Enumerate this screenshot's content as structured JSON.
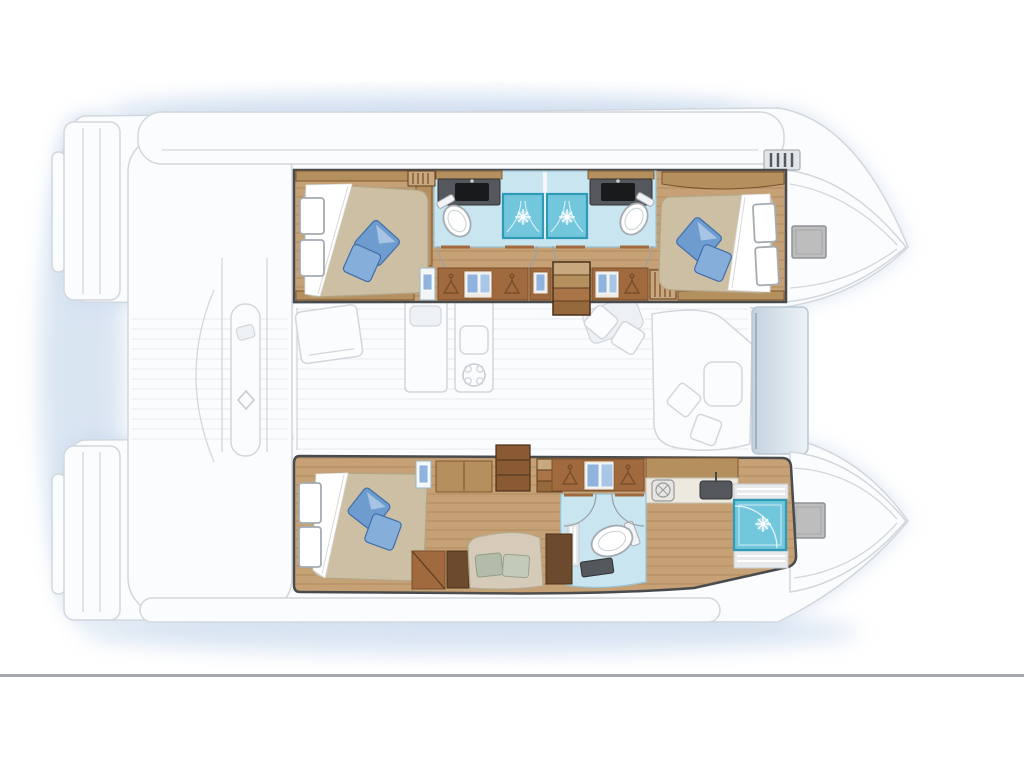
{
  "page": {
    "background": "#ffffff",
    "footer_rule": {
      "y": 674,
      "thickness": 3
    }
  },
  "palette": {
    "glow": "#b6cce6",
    "ghost-fill": "#fbfcfd",
    "ghost-stroke": "#d2d7dd",
    "outline-dark": "#474a4e",
    "wood-floor": "#c6a176",
    "wood-mid": "#b5905f",
    "wood-dark": "#a06a3e",
    "wood-darker": "#7a4f2a",
    "mattress": "#cdbfa4",
    "mattress-stroke": "#b3a586",
    "pillow": "#6f9ccf",
    "pillow-light": "#85aeda",
    "pillow-stroke": "#3f6ea8",
    "bath-floor": "#c9e5f0",
    "bath-stroke": "#97c3d7",
    "shower": "#72c7dd",
    "shower-stroke": "#2e9ab6",
    "fixture-stroke": "#a4abb1",
    "counter": "#54575b",
    "sink": "#191a1c",
    "sage": "#b3bba9",
    "sage2": "#c4cab9",
    "sofa": "#d6cbb8",
    "sofa-stroke": "#b5a98f",
    "hatch": "#bdbdbd",
    "hatch-stroke": "#8e9296",
    "divider": "#a5a9ae"
  },
  "floorplan": {
    "vessel": "catamaran",
    "view": "overhead interior deck plan",
    "orientation": "bow-right",
    "bridgedeck": {
      "label": "saloon-and-galley-ghosted",
      "fixtures": [
        "galley-island",
        "galley-sink",
        "galley-stove",
        "settee-cushions",
        "saloon-table",
        "companionway-stairs",
        "front-window-band"
      ]
    },
    "starboard_hull_top": {
      "label": "guest-hull",
      "rooms": [
        {
          "label": "aft-guest-cabin",
          "fixtures": [
            "double-berth",
            "white-headboard",
            "blue-pillows-x2",
            "wood-canopy",
            "slatted-step"
          ]
        },
        {
          "label": "aft-head",
          "fixtures": [
            "dark-vanity-counter",
            "basin",
            "toilet",
            "shower-with-sparkle"
          ]
        },
        {
          "label": "forward-head",
          "fixtures": [
            "dark-vanity-counter",
            "basin",
            "toilet",
            "shower-with-sparkle"
          ]
        },
        {
          "label": "corridor",
          "fixtures": [
            "hanging-lockers",
            "clothes-hangers",
            "blue-garments",
            "stairs-down",
            "slatted-vent"
          ]
        },
        {
          "label": "forward-guest-cabin",
          "fixtures": [
            "double-berth",
            "white-headboard",
            "blue-pillows-x2"
          ]
        },
        {
          "label": "bow-deck",
          "fixtures": [
            "deck-hatch",
            "winch-block"
          ]
        }
      ]
    },
    "port_hull_bottom": {
      "label": "owner-suite-hull",
      "rooms": [
        {
          "label": "owner-cabin-aft",
          "fixtures": [
            "double-berth",
            "white-headboard",
            "blue-pillows-x2",
            "dresser-steps",
            "dark-desk",
            "sofa-with-sage-cushions"
          ]
        },
        {
          "label": "dressing-area",
          "fixtures": [
            "vanity-mirror",
            "cabinets",
            "shelf-unit",
            "companionway-steps",
            "hanging-locker",
            "clothes-hangers",
            "blue-garments"
          ]
        },
        {
          "label": "owner-head",
          "fixtures": [
            "toilet",
            "dark-counter",
            "dark-cabinet",
            "washer-porthole",
            "basin",
            "teak-grating"
          ]
        },
        {
          "label": "forward-shower-room",
          "fixtures": [
            "walk-in-shower-with-sparkle",
            "teak-gratings-x2"
          ]
        },
        {
          "label": "bow-deck",
          "fixtures": [
            "deck-hatch"
          ]
        }
      ]
    },
    "exterior": {
      "aft": [
        "transom-steps-port",
        "transom-steps-starboard",
        "cockpit-walkway",
        "cockpit-table"
      ],
      "shadow": "soft-blue-glow-around-hulls"
    }
  }
}
